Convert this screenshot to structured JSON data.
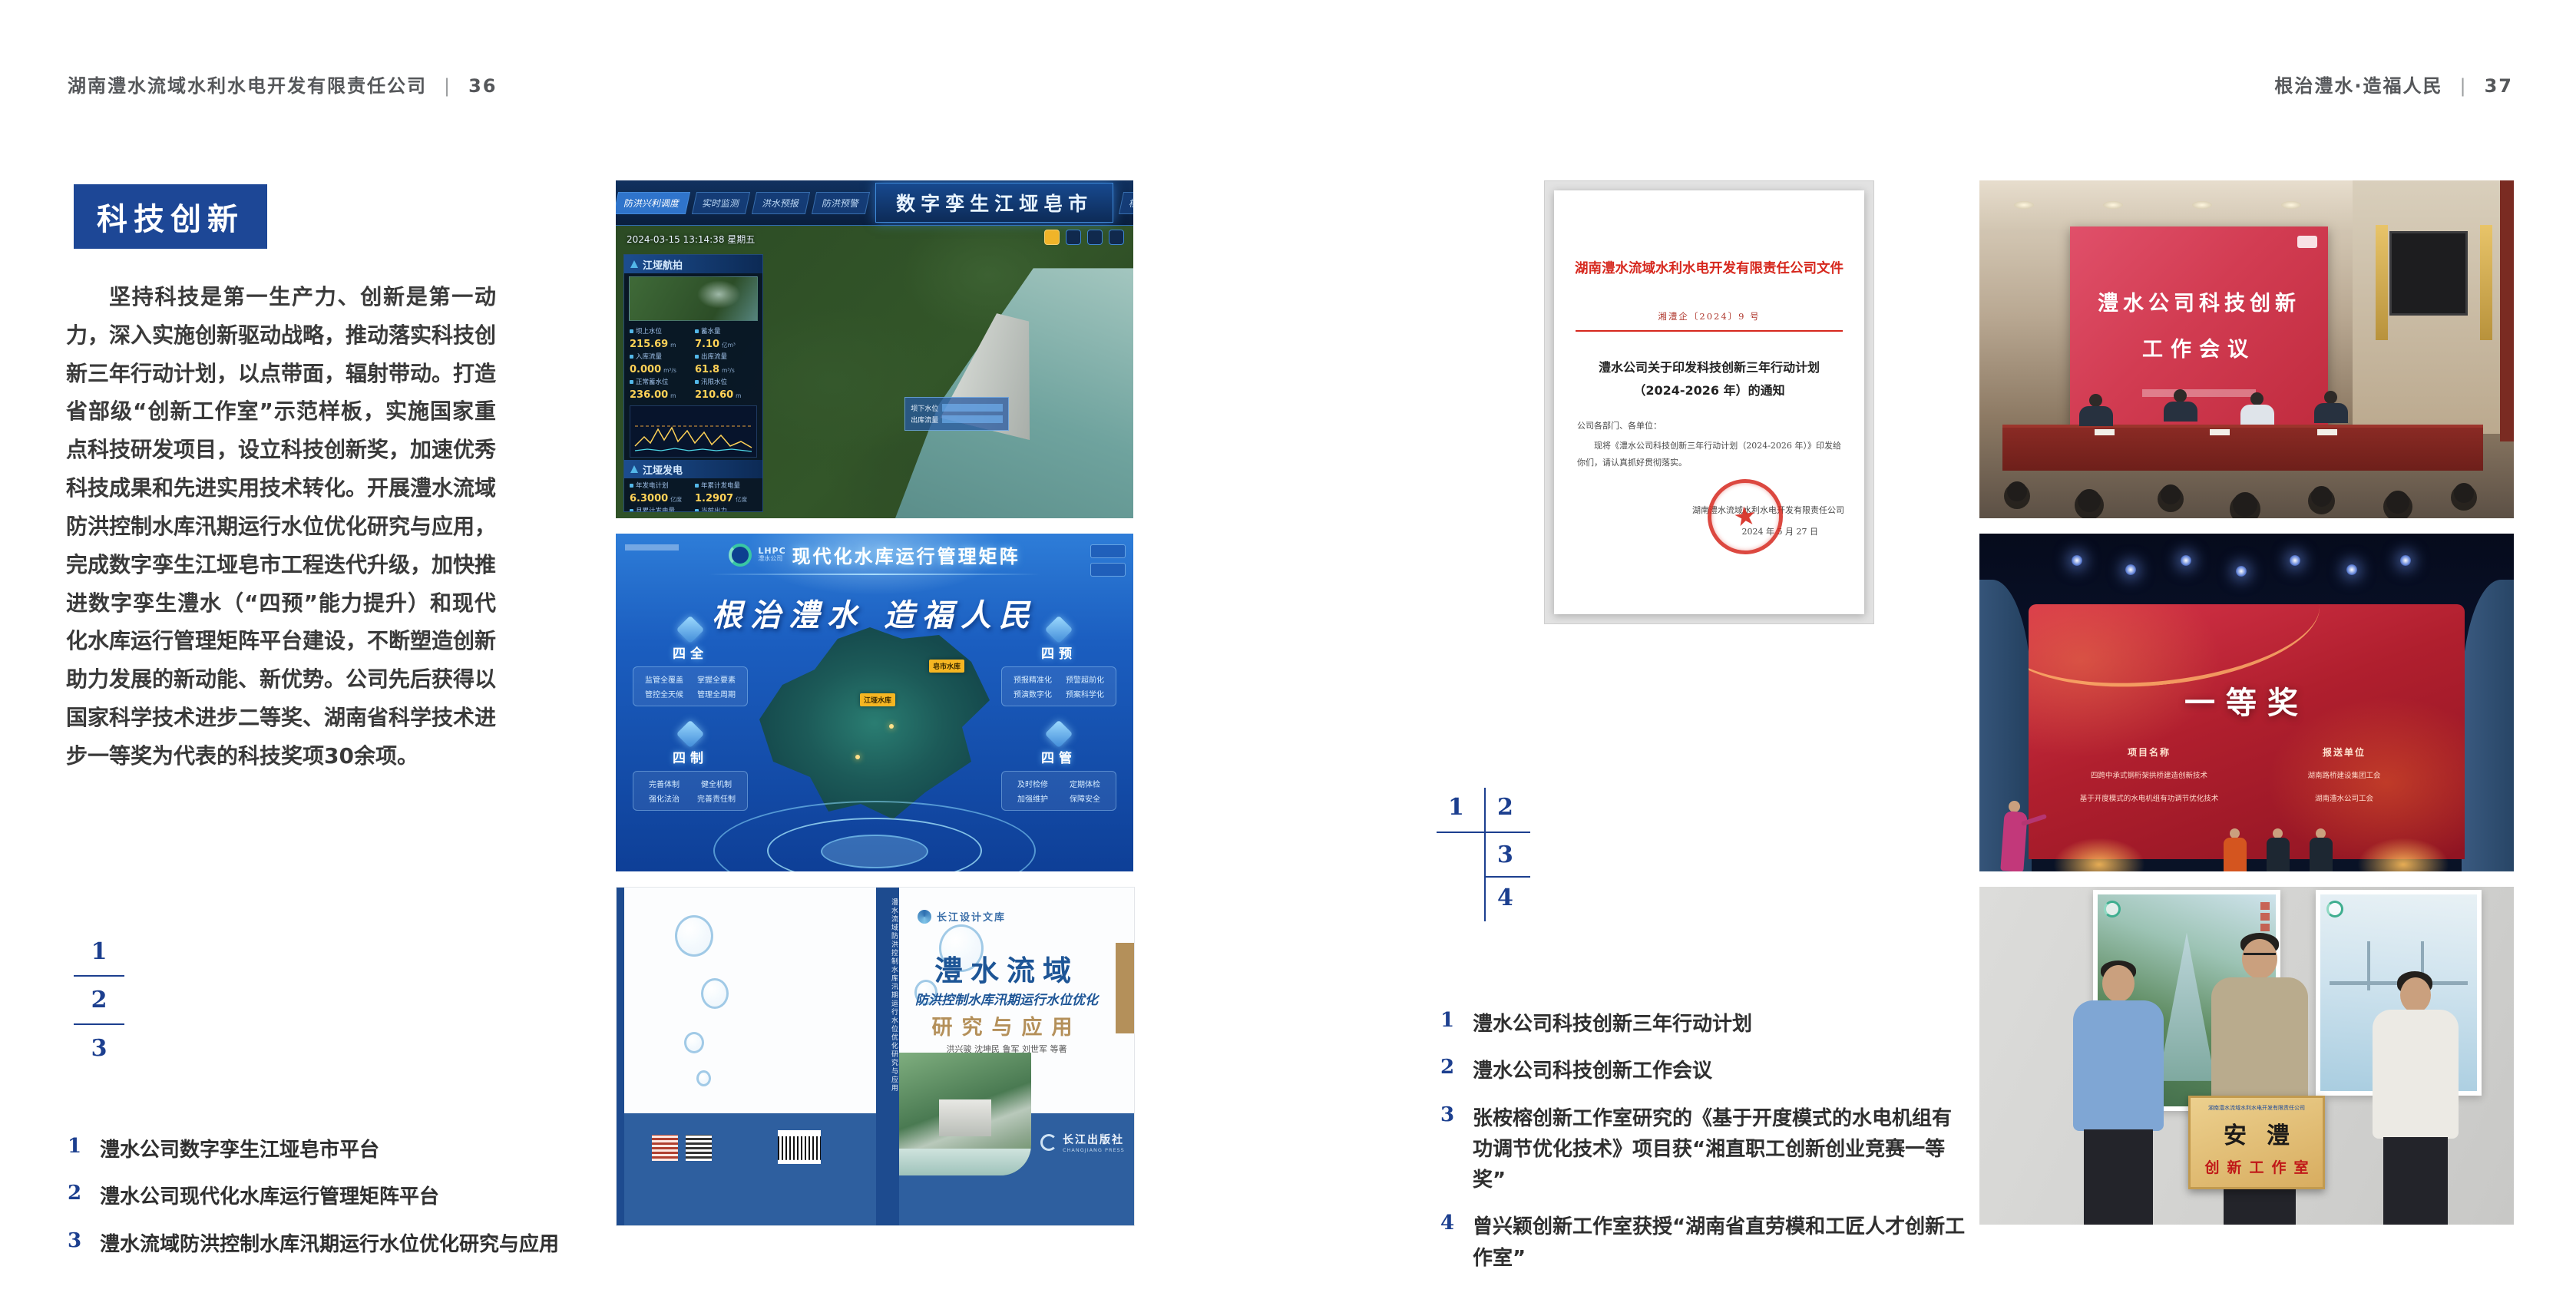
{
  "icons": {
    "star": "★"
  },
  "left": {
    "header": {
      "title": "湖南澧水流域水利水电开发有限责任公司",
      "separator": "|",
      "page": "36"
    },
    "section_title": "科技创新",
    "body": "坚持科技是第一生产力、创新是第一动力，深入实施创新驱动战略，推动落实科技创新三年行动计划，以点带面，辐射带动。打造省部级“创新工作室”示范样板，实施国家重点科技研发项目，设立科技创新奖，加速优秀科技成果和先进实用技术转化。开展澧水流域防洪控制水库汛期运行水位优化研究与应用，完成数字孪生江垭皂市工程迭代升级，加快推进数字孪生澧水（“四预”能力提升）和现代化水库运行管理矩阵平台建设，不断塑造创新助力发展的新动能、新优势。公司先后获得以国家科学技术进步二等奖、湖南省科学技术进步一等奖为代表的科技奖项30余项。",
    "figure_key": [
      "1",
      "2",
      "3"
    ],
    "captions": [
      {
        "num": "1",
        "text": "澧水公司数字孪生江垭皂市平台"
      },
      {
        "num": "2",
        "text": "澧水公司现代化水库运行管理矩阵平台"
      },
      {
        "num": "3",
        "text": "澧水流域防洪控制水库汛期运行水位优化研究与应用"
      }
    ],
    "figures": {
      "twin": {
        "title": "数字孪生江垭皂市",
        "timestamp": "2024-03-15 13:14:38 星期五",
        "tabs_left": [
          "防洪兴利调度",
          "实时监测",
          "洪水预报",
          "防洪预警"
        ],
        "tabs_right": [
          "模拟预演",
          "预案生成",
          "调度执行",
          "工程导览"
        ],
        "panel1_label": "江垭航拍",
        "panel2_label": "江垭发电",
        "stats": [
          {
            "label": "坝上水位",
            "value": "215.69",
            "unit": "m"
          },
          {
            "label": "蓄水量",
            "value": "7.10",
            "unit": "亿m³"
          },
          {
            "label": "入库流量",
            "value": "0.000",
            "unit": "m³/s"
          },
          {
            "label": "出库流量",
            "value": "61.8",
            "unit": "m³/s"
          },
          {
            "label": "正常蓄水位",
            "value": "236.00",
            "unit": "m"
          },
          {
            "label": "汛限水位",
            "value": "210.60",
            "unit": "m"
          }
        ],
        "power_stats": [
          {
            "label": "年发电计划",
            "value": "6.3000",
            "unit": "亿度"
          },
          {
            "label": "年累计发电量",
            "value": "1.2907",
            "unit": "亿度"
          },
          {
            "label": "月累计发电量",
            "value": "3259.21",
            "unit": "万度"
          },
          {
            "label": "当前出力",
            "value": "0.00",
            "unit": "MW"
          }
        ],
        "chip_labels": [
          "坝下水位",
          "出库流量"
        ]
      },
      "matrix": {
        "brand_en": "LHPC",
        "brand_cn": "澧水公司",
        "title": "现代化水库运行管理矩阵",
        "slogan": "根治澧水 造福人民",
        "map_labels": [
          "皂市水库",
          "江垭水库"
        ],
        "quadrants": [
          {
            "label": "四全",
            "items": [
              "监管全覆盖",
              "掌握全要素",
              "管控全天候",
              "管理全周期"
            ]
          },
          {
            "label": "四预",
            "items": [
              "预报精准化",
              "预警超前化",
              "预演数字化",
              "预案科学化"
            ]
          },
          {
            "label": "四制",
            "items": [
              "完善体制",
              "健全机制",
              "强化法治",
              "完善责任制"
            ]
          },
          {
            "label": "四管",
            "items": [
              "及时检修",
              "定期体检",
              "加强维护",
              "保障安全"
            ]
          }
        ]
      },
      "book": {
        "series": "长江设计文库",
        "title1": "澧水流域",
        "title2": "防洪控制水库汛期运行水位优化",
        "title3": "研究与应用",
        "authors": "洪兴骏 沈坤民 鲁军 刘世军 等著",
        "publisher": "长江出版社",
        "publisher_en": "CHANGJIANG PRESS",
        "spine_text": "澧水流域防洪控制水库汛期运行水位优化研究与应用"
      }
    }
  },
  "right": {
    "header": {
      "title": "根治澧水·造福人民",
      "separator": "|",
      "page": "37"
    },
    "document": {
      "red_title": "湖南澧水流域水利水电开发有限责任公司文件",
      "doc_number": "湘澧企〔2024〕9 号",
      "subject_line1": "澧水公司关于印发科技创新三年行动计划",
      "subject_line2": "（2024-2026 年）的通知",
      "salutation": "公司各部门、各单位：",
      "body": "现将《澧水公司科技创新三年行动计划（2024-2026 年）》印发给你们，请认真抓好贯彻落实。",
      "signature": "湖南澧水流域水利水电开发有限责任公司",
      "date": "2024 年 5 月 27 日"
    },
    "figure_key": [
      "1",
      "2",
      "3",
      "4"
    ],
    "captions": [
      {
        "num": "1",
        "text": "澧水公司科技创新三年行动计划"
      },
      {
        "num": "2",
        "text": "澧水公司科技创新工作会议"
      },
      {
        "num": "3",
        "text": "张桉榕创新工作室研究的《基于开度模式的水电机组有功调节优化技术》项目获“湘直职工创新创业竞赛一等奖”"
      },
      {
        "num": "4",
        "text": "曾兴颖创新工作室获授“湖南省直劳模和工匠人才创新工作室”"
      }
    ],
    "photos": {
      "meeting": {
        "screen_line1": "澧水公司科技创新",
        "screen_line2": "工作会议"
      },
      "award": {
        "headline": "一等奖",
        "col1": "项目名称",
        "col2": "报送单位",
        "rows": [
          {
            "project": "四跨中承式钢桁架拱桥建造创新技术",
            "unit": "湖南路桥建设集团工会"
          },
          {
            "project": "基于开度模式的水电机组有功调节优化技术",
            "unit": "湖南澧水公司工会"
          }
        ]
      },
      "plaque": {
        "header": "湖南澧水流域水利水电开发有限责任公司",
        "title": "安澧",
        "subtitle": "创新工作室"
      }
    }
  }
}
